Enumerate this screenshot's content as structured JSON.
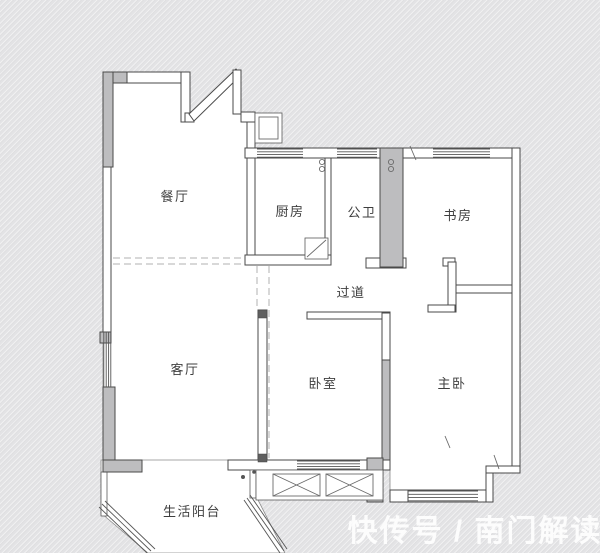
{
  "floorplan": {
    "rooms": {
      "dining": "餐厅",
      "kitchen": "厨房",
      "bathroom": "公卫",
      "study": "书房",
      "hallway": "过道",
      "living": "客厅",
      "bedroom": "卧室",
      "master_bedroom": "主卧",
      "balcony": "生活阳台"
    },
    "watermark": "快传号 / 南门解读",
    "colors": {
      "background": "#e3e3e5",
      "wall_outline": "#4a4a4a",
      "load_bearing_fill": "#bdbdbf",
      "interior_fill": "#ffffff",
      "watermark_text": "#ffffff"
    }
  }
}
